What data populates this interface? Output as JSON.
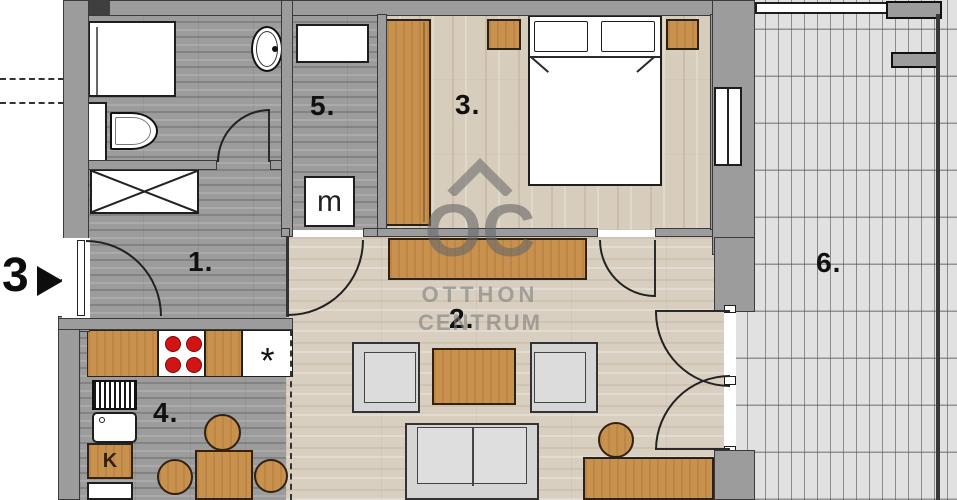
{
  "plan": {
    "room_labels": {
      "r1": "1.",
      "r2": "2.",
      "r3": "3.",
      "r4": "4.",
      "r5": "5.",
      "r6": "6."
    },
    "entrance": {
      "number": "3"
    },
    "appliance_labels": {
      "washing_machine": "m",
      "fridge": "K",
      "star": "*"
    },
    "watermark": {
      "logo": "OC",
      "line1": "OTTHON",
      "line2": "CENTRUM"
    },
    "colors": {
      "wall_gray": "#9c9c9c",
      "wall_outline": "#3a3a3a",
      "furniture_wood": "#c9914e",
      "floor_gray": "#9c9c9c",
      "floor_light": "#d8cfc0",
      "terrace_tile": "#e1e1e1",
      "burner_red": "#d31414",
      "upholstery_gray": "#d5d5d5",
      "watermark_gray": "#6e6e6e"
    }
  }
}
